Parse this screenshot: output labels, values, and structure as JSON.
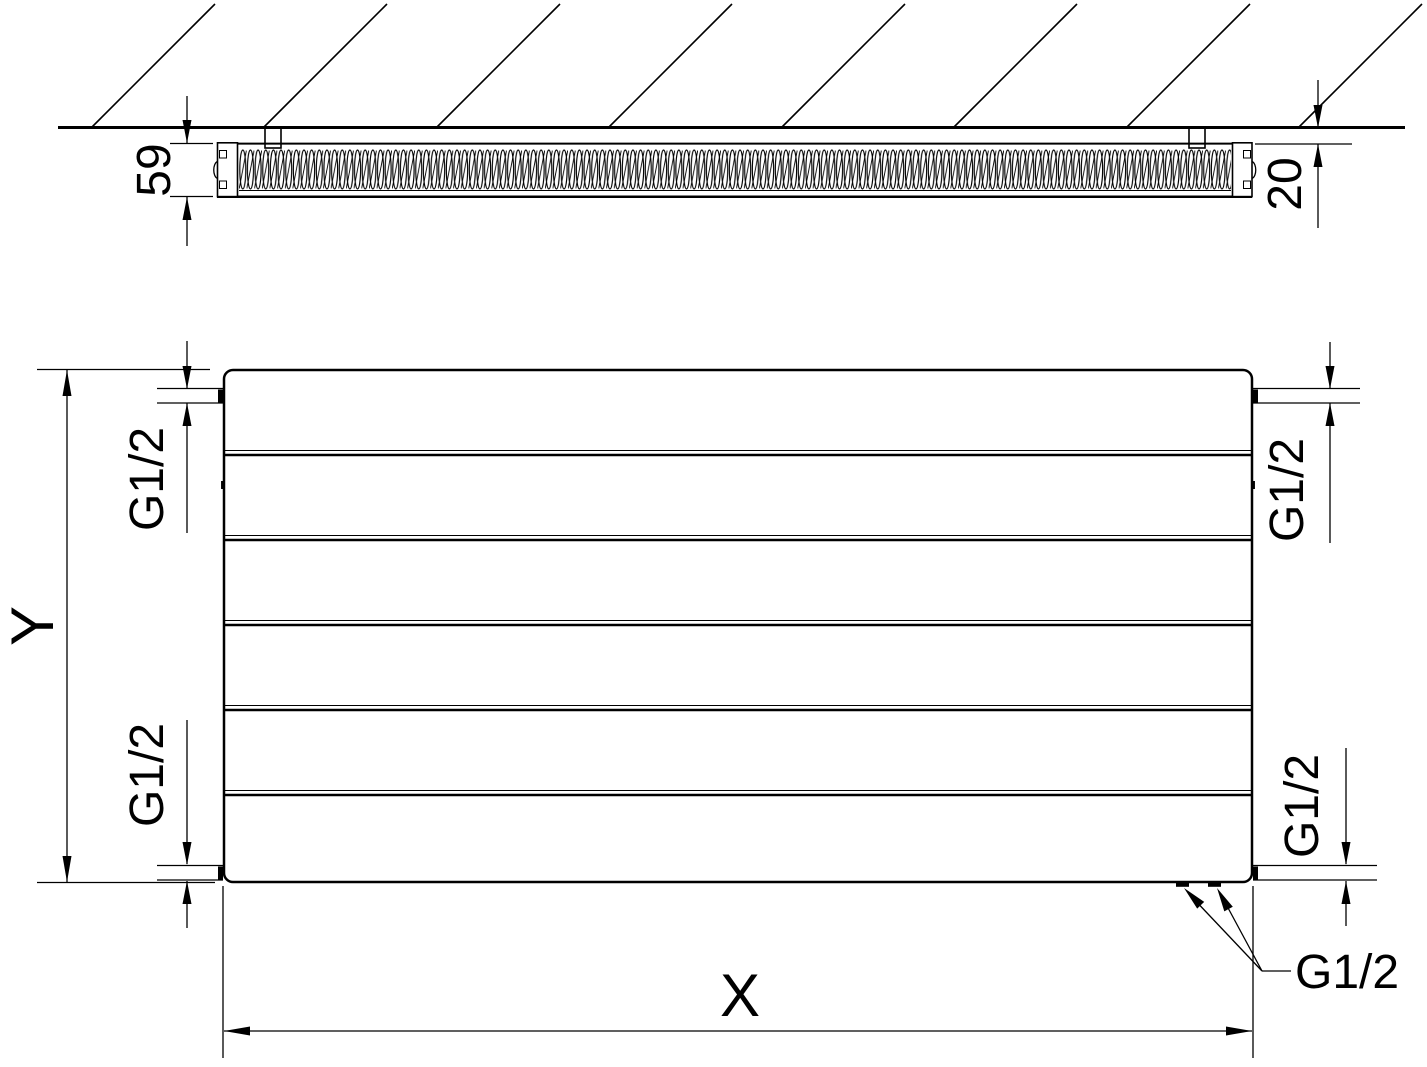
{
  "drawing": {
    "background": "#ffffff",
    "line_color": "#000000",
    "section_view": {
      "description": "wall-mounted radiator cross-section",
      "height_label": "59",
      "wall_gap_label": "20"
    },
    "front_view": {
      "description": "panel radiator front view",
      "panel_count": 6,
      "width_label": "X",
      "height_label": "Y",
      "connections": {
        "top_left_label": "G1/2",
        "top_right_label": "G1/2",
        "bottom_left_label": "G1/2",
        "bottom_right_label": "G1/2",
        "bottom_callout_label": "G1/2"
      }
    }
  }
}
